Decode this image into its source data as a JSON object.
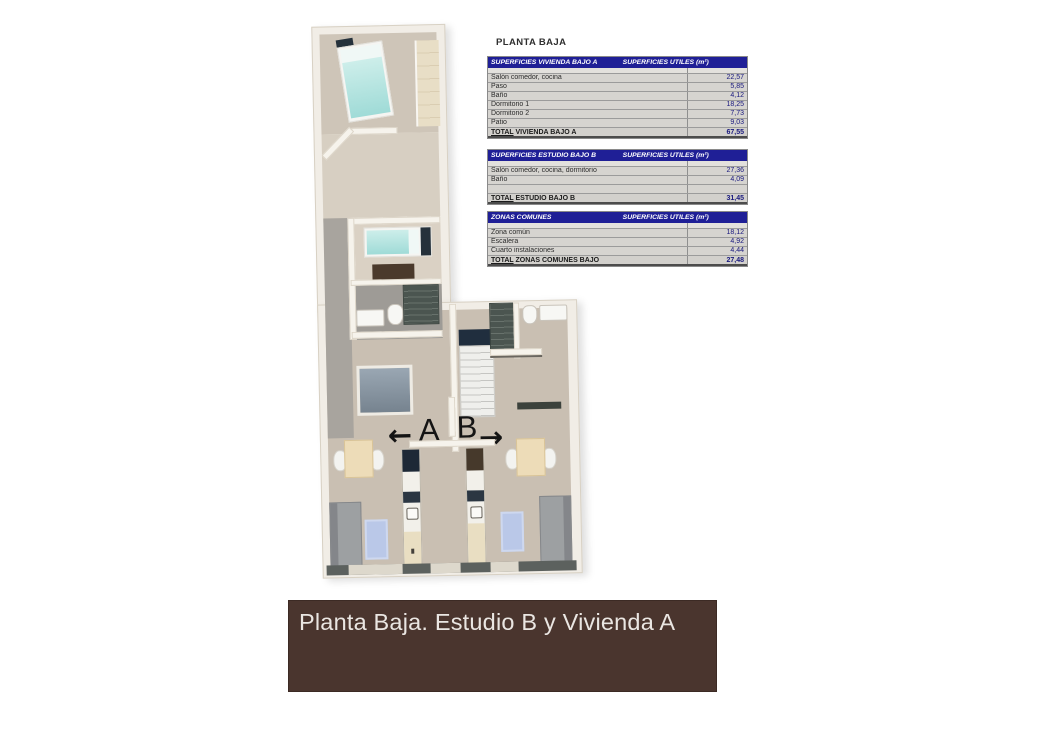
{
  "plan": {
    "label_a": "A",
    "label_b": "B",
    "arrow_left": "←",
    "arrow_right": "→"
  },
  "panel": {
    "title": "PLANTA BAJA",
    "unit_header": "SUPERFICIES UTILES  (m²)",
    "tables": [
      {
        "name": "SUPERFICIES VIVIENDA BAJO A",
        "rows": [
          {
            "label": "Salón comedor, cocina",
            "value": "22,57"
          },
          {
            "label": "Paso",
            "value": "5,85"
          },
          {
            "label": "Baño",
            "value": "4,12"
          },
          {
            "label": "Dormitorio 1",
            "value": "18,25"
          },
          {
            "label": "Dormitorio 2",
            "value": "7,73"
          },
          {
            "label": "Patio",
            "value": "9,03"
          }
        ],
        "total": {
          "prefix": "TOTAL",
          "rest": " VIVIENDA BAJO A",
          "value": "67,55"
        }
      },
      {
        "name": "SUPERFICIES ESTUDIO BAJO B",
        "rows": [
          {
            "label": "Salón comedor, cocina, dormitorio",
            "value": "27,36"
          },
          {
            "label": "Baño",
            "value": "4,09"
          },
          {
            "label": "",
            "value": ""
          }
        ],
        "total": {
          "prefix": "TOTAL",
          "rest": " ESTUDIO BAJO B",
          "value": "31,45"
        }
      },
      {
        "name": "ZONAS COMUNES",
        "rows": [
          {
            "label": "Zona común",
            "value": "18,12"
          },
          {
            "label": "Escalera",
            "value": "4,92"
          },
          {
            "label": "Cuarto instalaciones",
            "value": "4,44"
          }
        ],
        "total": {
          "prefix": "TOTAL",
          "rest": " ZONAS COMUNES BAJO",
          "value": "27,48"
        }
      }
    ]
  },
  "footer": {
    "title": "Planta Baja. Estudio B y Vivienda A"
  },
  "colors": {
    "table_header_bg": "#1f1f96",
    "value_text": "#18187e",
    "footer_bg": "#4a352e",
    "footer_text": "#eae6e2"
  }
}
